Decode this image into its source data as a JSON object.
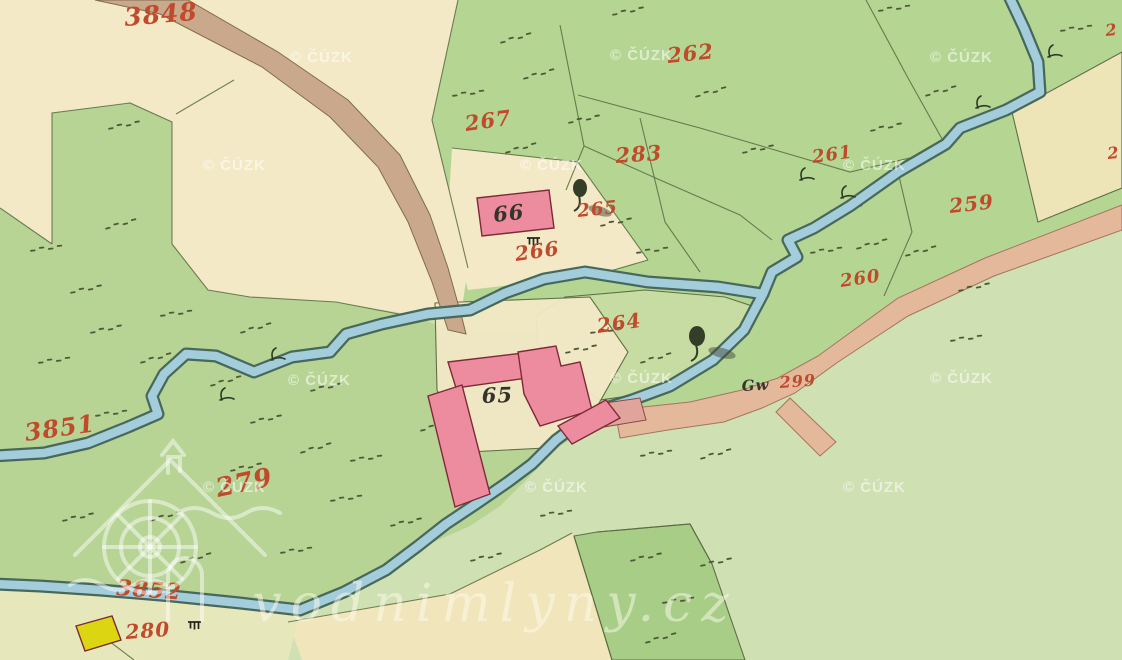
{
  "map": {
    "type": "historical-cadastral-map",
    "copyright_watermark": "© ČÚZK",
    "site_watermark": "vodnimlyny.cz",
    "parcel_numbers": {
      "p3848": "3848",
      "p262": "262",
      "p267": "267",
      "p283": "283",
      "p261": "261",
      "p259": "259",
      "p265": "265",
      "p266": "266",
      "p260": "260",
      "p264": "264",
      "p299": "299",
      "p3851": "3851",
      "p279": "279",
      "p3852": "3852",
      "p280": "280",
      "edge_top": "2",
      "edge_right": "2"
    },
    "building_numbers": {
      "b66": "66",
      "b65": "65"
    },
    "annotations": {
      "gw": "Gw"
    },
    "colors": {
      "paper_cream": "#f3e9c6",
      "field_cream": "#f0e5bb",
      "strip_cream": "#e6e7ba",
      "meadow_green": "#b7d494",
      "parcel_green": "#b5d693",
      "pale_green": "#cfe0b2",
      "island_green": "#c8dda4",
      "dark_green": "#a5cc84",
      "stream_fill": "#a3cdda",
      "stream_edge": "#47685b",
      "road_brown": "#c9a88b",
      "road_pink": "#e4b89a",
      "bridge_pink": "#e0a49c",
      "building_pink": "#ee8c9f",
      "building_outline": "#7d2a37",
      "building_yellow": "#dcd512",
      "label_red": "#c04a2c",
      "label_black": "#35342a",
      "boundary_line": "#5a6a41"
    }
  }
}
